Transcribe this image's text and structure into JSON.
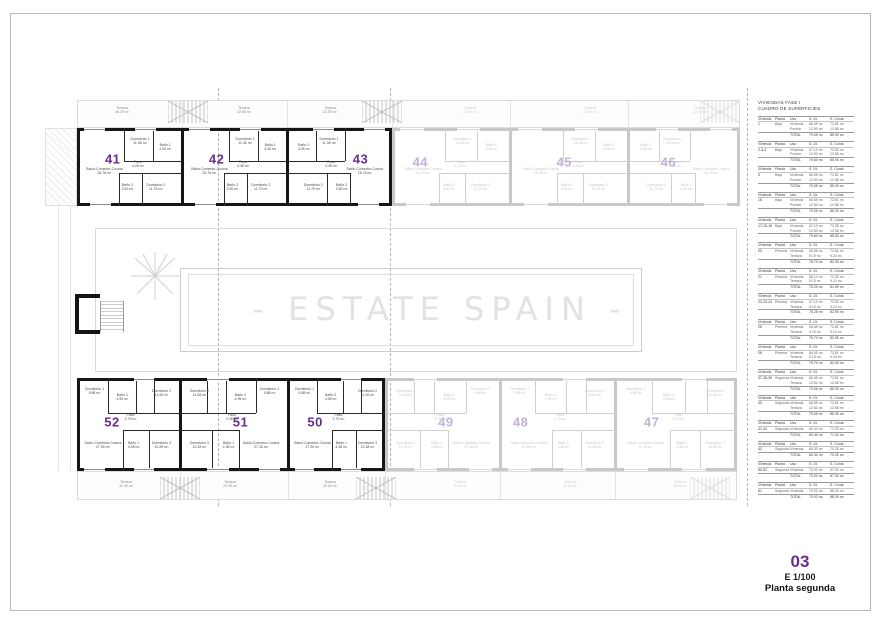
{
  "watermark": "- ESTATE SPAIN -",
  "title_block": {
    "sheet_number": "03",
    "scale": "E 1/100",
    "plan_name": "Planta segunda"
  },
  "colors": {
    "accent": "#6a2d91",
    "accent_faded": "#c2b3d6",
    "wall": "#161616",
    "wall_faded": "#c8c8c8",
    "room_text": "#4a4a4a",
    "room_text_faded": "#c6c6c6",
    "window_line": "#8a8a8a",
    "window_line_faded": "#d8d8d8",
    "watermark": "#e2e2e2"
  },
  "surfaces_table": {
    "title_line1": "VIVIENDAS FASE I",
    "title_line2": "CUADRO DE SUPERFICIES",
    "headers": [
      "Vivienda",
      "Planta",
      "Uso",
      "S. Út.",
      "S. Const."
    ],
    "total_label": "TOTAL",
    "blocks": [
      {
        "vivienda": "1",
        "planta": "Baja",
        "rows": [
          [
            "Vivienda",
            "66.55 m²",
            "72.81 m²"
          ],
          [
            "Porche",
            "12.50 m²",
            "12.58 m²"
          ]
        ],
        "total": [
          "79.05 m²",
          "85.39 m²"
        ]
      },
      {
        "vivienda": "2-3-4",
        "planta": "Baja",
        "rows": [
          [
            "Vivienda",
            "67.10 m²",
            "73.35 m²"
          ],
          [
            "Porche",
            "12.50 m²",
            "12.58 m²"
          ]
        ],
        "total": [
          "79.60 m²",
          "85.93 m²"
        ]
      },
      {
        "vivienda": "5",
        "planta": "Baja",
        "rows": [
          [
            "Vivienda",
            "66.55 m²",
            "72.81 m²"
          ],
          [
            "Porche",
            "12.50 m²",
            "12.58 m²"
          ]
        ],
        "total": [
          "79.05 m²",
          "85.39 m²"
        ]
      },
      {
        "vivienda": "16",
        "planta": "Baja",
        "rows": [
          [
            "Vivienda",
            "66.55 m²",
            "72.81 m²"
          ],
          [
            "Porche",
            "12.50 m²",
            "12.58 m²"
          ]
        ],
        "total": [
          "79.05 m²",
          "85.39 m²"
        ]
      },
      {
        "vivienda": "17-18-19",
        "planta": "Baja",
        "rows": [
          [
            "Vivienda",
            "67.10 m²",
            "73.35 m²"
          ],
          [
            "Porche",
            "12.50 m²",
            "12.58 m²"
          ]
        ],
        "total": [
          "79.60 m²",
          "85.93 m²"
        ]
      },
      {
        "vivienda": "20",
        "planta": "Primera",
        "rows": [
          [
            "Vivienda",
            "66.55 m²",
            "72.81 m²"
          ],
          [
            "Terraza",
            "9.15 m²",
            "9.24 m²"
          ]
        ],
        "total": [
          "75.70 m²",
          "82.05 m²"
        ]
      },
      {
        "vivienda": "21",
        "planta": "Primera",
        "rows": [
          [
            "Vivienda",
            "66.10 m²",
            "72.35 m²"
          ],
          [
            "Terraza",
            "9.15 m²",
            "9.24 m²"
          ]
        ],
        "total": [
          "75.25 m²",
          "81.59 m²"
        ]
      },
      {
        "vivienda": "22-23-24",
        "planta": "Primera",
        "rows": [
          [
            "Vivienda",
            "67.10 m²",
            "73.35 m²"
          ],
          [
            "Terraza",
            "9.15 m²",
            "9.24 m²"
          ]
        ],
        "total": [
          "76.25 m²",
          "82.59 m²"
        ]
      },
      {
        "vivienda": "25",
        "planta": "Primera",
        "rows": [
          [
            "Vivienda",
            "66.55 m²",
            "72.81 m²"
          ],
          [
            "Terraza",
            "9.15 m²",
            "9.24 m²"
          ]
        ],
        "total": [
          "75.70 m²",
          "82.05 m²"
        ]
      },
      {
        "vivienda": "26",
        "planta": "Primera",
        "rows": [
          [
            "Vivienda",
            "66.55 m²",
            "72.81 m²"
          ],
          [
            "Terraza",
            "9.15 m²",
            "9.24 m²"
          ]
        ],
        "total": [
          "75.70 m²",
          "82.05 m²"
        ]
      },
      {
        "vivienda": "37-38-39",
        "planta": "Segunda",
        "rows": [
          [
            "Vivienda",
            "66.55 m²",
            "72.81 m²"
          ],
          [
            "Terraza",
            "12.50 m²",
            "12.58 m²"
          ]
        ],
        "total": [
          "79.05 m²",
          "85.39 m²"
        ]
      },
      {
        "vivienda": "40",
        "planta": "Segunda",
        "rows": [
          [
            "Vivienda",
            "66.55 m²",
            "72.81 m²"
          ],
          [
            "Terraza",
            "12.50 m²",
            "12.58 m²"
          ]
        ],
        "total": [
          "79.05 m²",
          "85.39 m²"
        ]
      },
      {
        "vivienda": "41-43",
        "planta": "Segunda",
        "rows": [
          [
            "Vivienda",
            "60.40 m²",
            "71.20 m²"
          ]
        ],
        "total": [
          "60.40 m²",
          "71.20 m²"
        ]
      },
      {
        "vivienda": "42",
        "planta": "Segunda",
        "rows": [
          [
            "Vivienda",
            "60.30 m²",
            "70.25 m²"
          ]
        ],
        "total": [
          "60.30 m²",
          "70.25 m²"
        ]
      },
      {
        "vivienda": "50-52",
        "planta": "Segunda",
        "rows": [
          [
            "Vivienda",
            "70.02 m²",
            "87.00 m²"
          ]
        ],
        "total": [
          "70.02 m²",
          "87.00 m²"
        ]
      },
      {
        "vivienda": "51",
        "planta": "Segunda",
        "rows": [
          [
            "Vivienda",
            "70.02 m²",
            "88.30 m²"
          ]
        ],
        "total": [
          "70.02 m²",
          "88.30 m²"
        ]
      }
    ]
  },
  "plan": {
    "terraces_top": [
      {
        "label": "Terraza",
        "area": "46.19 m²",
        "state": "active"
      },
      {
        "label": "Terraza",
        "area": "22.55 m²",
        "state": "active"
      },
      {
        "label": "Terraza",
        "area": "22.55 m²",
        "state": "active"
      },
      {
        "label": "Terraza",
        "area": "22.55 m²",
        "state": "faded"
      },
      {
        "label": "Terraza",
        "area": "22.55 m²",
        "state": "faded"
      },
      {
        "label": "Terraza",
        "area": "22.55 m²",
        "state": "faded"
      }
    ],
    "terraces_bottom": [
      {
        "label": "Terraza",
        "area": "41.09 m²",
        "state": "active"
      },
      {
        "label": "Terraza",
        "area": "23.05 m²",
        "state": "active"
      },
      {
        "label": "Terraza",
        "area": "23.05 m²",
        "state": "active"
      },
      {
        "label": "Terraza",
        "area": "23.05 m²",
        "state": "faded"
      },
      {
        "label": "Terraza",
        "area": "23.05 m²",
        "state": "faded"
      },
      {
        "label": "Terraza",
        "area": "23.05 m²",
        "state": "faded"
      }
    ],
    "units": [
      {
        "id": "41",
        "number": "41",
        "state": "active",
        "rooms": [
          {
            "key": "salon",
            "name": "Salón-Comedor-Cocina",
            "area": "26.76 m²"
          },
          {
            "key": "dorm1",
            "name": "Dormitorio 1",
            "area": "11.06 m²"
          },
          {
            "key": "bano1",
            "name": "Baño 1",
            "area": "4.06 m²"
          },
          {
            "key": "paso",
            "name": "Paso",
            "area": "4.28 m²"
          },
          {
            "key": "bano2",
            "name": "Baño 2",
            "area": "3.90 m²"
          },
          {
            "key": "dorm2",
            "name": "Dormitorio 2",
            "area": "11.79 m²"
          }
        ]
      },
      {
        "id": "42",
        "number": "42",
        "state": "active",
        "rooms": [
          {
            "key": "salon",
            "name": "Salón-Comedor-Cocina",
            "area": "26.76 m²"
          },
          {
            "key": "dorm1",
            "name": "Dormitorio 1",
            "area": "11.06 m²"
          },
          {
            "key": "bano1",
            "name": "Baño 1",
            "area": "4.06 m²"
          },
          {
            "key": "paso",
            "name": "Paso",
            "area": "4.38 m²"
          },
          {
            "key": "bano2",
            "name": "Baño 2",
            "area": "3.90 m²"
          },
          {
            "key": "dorm2",
            "name": "Dormitorio 2",
            "area": "11.79 m²"
          }
        ]
      },
      {
        "id": "43",
        "number": "43",
        "state": "active",
        "rooms": [
          {
            "key": "salon",
            "name": "Salón-Comedor-Cocina",
            "area": "26.76 m²"
          },
          {
            "key": "dorm1",
            "name": "Dormitorio 1",
            "area": "11.06 m²"
          },
          {
            "key": "bano1",
            "name": "Baño 1",
            "area": "4.06 m²"
          },
          {
            "key": "paso",
            "name": "Paso",
            "area": "4.28 m²"
          },
          {
            "key": "bano2",
            "name": "Baño 2",
            "area": "3.90 m²"
          },
          {
            "key": "dorm2",
            "name": "Dormitorio 2",
            "area": "11.79 m²"
          }
        ]
      },
      {
        "id": "44",
        "number": "44",
        "state": "faded",
        "rooms": [
          {
            "key": "salon",
            "name": "Salón-Comedor-Cocina",
            "area": "26.76 m²"
          },
          {
            "key": "dorm1",
            "name": "Dormitorio 1",
            "area": "11.06 m²"
          },
          {
            "key": "bano1",
            "name": "Baño 1",
            "area": "4.06 m²"
          },
          {
            "key": "paso",
            "name": "Paso",
            "area": "4.28 m²"
          },
          {
            "key": "bano2",
            "name": "Baño 2",
            "area": "3.90 m²"
          },
          {
            "key": "dorm2",
            "name": "Dormitorio 2",
            "area": "11.79 m²"
          }
        ]
      },
      {
        "id": "45",
        "number": "45",
        "state": "faded",
        "rooms": [
          {
            "key": "salon",
            "name": "Salón-Comedor-Cocina",
            "area": "26.76 m²"
          },
          {
            "key": "dorm1",
            "name": "Dormitorio 1",
            "area": "11.06 m²"
          },
          {
            "key": "bano1",
            "name": "Baño 1",
            "area": "4.06 m²"
          },
          {
            "key": "paso",
            "name": "Paso",
            "area": "4.28 m²"
          },
          {
            "key": "bano2",
            "name": "Baño 2",
            "area": "3.90 m²"
          },
          {
            "key": "dorm2",
            "name": "Dormitorio 2",
            "area": "11.79 m²"
          }
        ]
      },
      {
        "id": "46",
        "number": "46",
        "state": "faded",
        "rooms": [
          {
            "key": "salon",
            "name": "Salón-Comedor-Cocina",
            "area": "26.76 m²"
          },
          {
            "key": "dorm1",
            "name": "Dormitorio 1",
            "area": "11.06 m²"
          },
          {
            "key": "bano1",
            "name": "Baño 1",
            "area": "4.06 m²"
          },
          {
            "key": "paso",
            "name": "Paso",
            "area": "4.28 m²"
          },
          {
            "key": "bano2",
            "name": "Baño 2",
            "area": "3.90 m²"
          },
          {
            "key": "dorm2",
            "name": "Dormitorio 2",
            "area": "11.79 m²"
          }
        ]
      },
      {
        "id": "52",
        "number": "52",
        "state": "active",
        "rooms": [
          {
            "key": "dorm1",
            "name": "Dormitorio 1",
            "area": "9.88 m²"
          },
          {
            "key": "bano2",
            "name": "Baño 2",
            "area": "4.95 m²"
          },
          {
            "key": "dorm2",
            "name": "Dormitorio 2",
            "area": "11.06 m²"
          },
          {
            "key": "paso",
            "name": "Paso",
            "area": "2.79 m²"
          },
          {
            "key": "salon",
            "name": "Salón-Comedor-Cocina",
            "area": "27.26 m²"
          },
          {
            "key": "bano1",
            "name": "Baño 1",
            "area": "4.38 m²"
          },
          {
            "key": "dorm3",
            "name": "Dormitorio 3",
            "area": "10.28 m²"
          }
        ]
      },
      {
        "id": "51",
        "number": "51",
        "state": "active",
        "rooms": [
          {
            "key": "dorm1",
            "name": "Dormitorio 1",
            "area": "9.88 m²"
          },
          {
            "key": "bano2",
            "name": "Baño 2",
            "area": "4.95 m²"
          },
          {
            "key": "dorm2",
            "name": "Dormitorio 2",
            "area": "11.06 m²"
          },
          {
            "key": "paso",
            "name": "Paso",
            "area": "2.48 m²"
          },
          {
            "key": "salon",
            "name": "Salón-Comedor-Cocina",
            "area": "27.26 m²"
          },
          {
            "key": "bano1",
            "name": "Baño 1",
            "area": "4.38 m²"
          },
          {
            "key": "dorm3",
            "name": "Dormitorio 3",
            "area": "10.28 m²"
          }
        ]
      },
      {
        "id": "50",
        "number": "50",
        "state": "active",
        "rooms": [
          {
            "key": "dorm1",
            "name": "Dormitorio 1",
            "area": "9.88 m²"
          },
          {
            "key": "bano2",
            "name": "Baño 2",
            "area": "4.95 m²"
          },
          {
            "key": "dorm2",
            "name": "Dormitorio 2",
            "area": "11.06 m²"
          },
          {
            "key": "paso",
            "name": "Paso",
            "area": "2.79 m²"
          },
          {
            "key": "salon",
            "name": "Salón-Comedor-Cocina",
            "area": "27.26 m²"
          },
          {
            "key": "bano1",
            "name": "Baño 1",
            "area": "4.38 m²"
          },
          {
            "key": "dorm3",
            "name": "Dormitorio 3",
            "area": "10.28 m²"
          }
        ]
      },
      {
        "id": "49",
        "number": "49",
        "state": "faded",
        "rooms": [
          {
            "key": "dorm1",
            "name": "Dormitorio 1",
            "area": "9.88 m²"
          },
          {
            "key": "bano2",
            "name": "Baño 2",
            "area": "4.95 m²"
          },
          {
            "key": "dorm2",
            "name": "Dormitorio 2",
            "area": "11.06 m²"
          },
          {
            "key": "paso",
            "name": "Paso",
            "area": "2.79 m²"
          },
          {
            "key": "salon",
            "name": "Salón-Comedor-Cocina",
            "area": "27.26 m²"
          },
          {
            "key": "bano1",
            "name": "Baño 1",
            "area": "4.38 m²"
          },
          {
            "key": "dorm3",
            "name": "Dormitorio 3",
            "area": "10.28 m²"
          }
        ]
      },
      {
        "id": "48",
        "number": "48",
        "state": "faded",
        "rooms": [
          {
            "key": "dorm1",
            "name": "Dormitorio 1",
            "area": "9.88 m²"
          },
          {
            "key": "bano2",
            "name": "Baño 2",
            "area": "4.95 m²"
          },
          {
            "key": "dorm2",
            "name": "Dormitorio 2",
            "area": "11.06 m²"
          },
          {
            "key": "paso",
            "name": "Paso",
            "area": "2.79 m²"
          },
          {
            "key": "salon",
            "name": "Salón-Comedor-Cocina",
            "area": "27.26 m²"
          },
          {
            "key": "bano1",
            "name": "Baño 1",
            "area": "4.38 m²"
          },
          {
            "key": "dorm3",
            "name": "Dormitorio 3",
            "area": "10.28 m²"
          }
        ]
      },
      {
        "id": "47",
        "number": "47",
        "state": "faded",
        "rooms": [
          {
            "key": "dorm1",
            "name": "Dormitorio 1",
            "area": "9.88 m²"
          },
          {
            "key": "bano2",
            "name": "Baño 2",
            "area": "4.95 m²"
          },
          {
            "key": "dorm2",
            "name": "Dormitorio 2",
            "area": "11.06 m²"
          },
          {
            "key": "paso",
            "name": "Paso",
            "area": "2.79 m²"
          },
          {
            "key": "salon",
            "name": "Salón-Comedor-Cocina",
            "area": "27.26 m²"
          },
          {
            "key": "bano1",
            "name": "Baño 1",
            "area": "4.38 m²"
          },
          {
            "key": "dorm3",
            "name": "Dormitorio 3",
            "area": "10.28 m²"
          }
        ]
      }
    ]
  }
}
